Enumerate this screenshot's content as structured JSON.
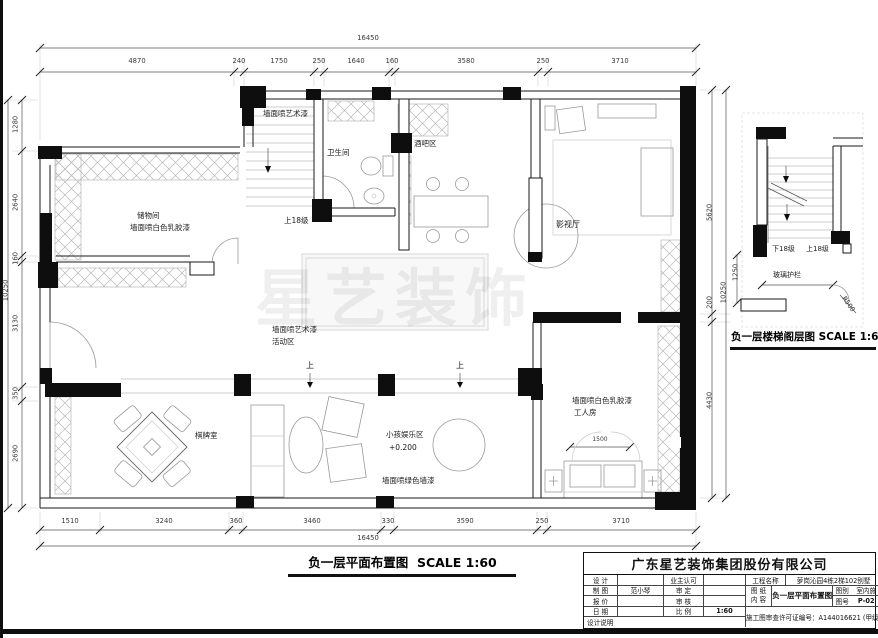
{
  "watermark": "星艺装饰",
  "plan": {
    "title": "负一层平面布置图",
    "title_scale": "SCALE 1:60",
    "dims": {
      "top_total": "16450",
      "top": [
        "4870",
        "240",
        "1750",
        "250",
        "1640",
        "160",
        "3580",
        "250",
        "3710"
      ],
      "bottom": [
        "1510",
        "3240",
        "360",
        "3460",
        "330",
        "3590",
        "250",
        "3710"
      ],
      "bottom_total": "16450",
      "left": [
        "1280",
        "2640",
        "160",
        "3130",
        "350",
        "2690"
      ],
      "left_total": "10250",
      "right": [
        "5620",
        "200",
        "4430"
      ],
      "right_total": "10250",
      "worker_bed": "1500"
    },
    "labels": {
      "art_paint_top": "墙面喷艺术漆",
      "storage": "储物间",
      "storage_paint": "墙面喷白色乳胶漆",
      "bathroom": "卫生间",
      "bar": "酒吧区",
      "stairs_up": "上18级",
      "cinema": "影视厅",
      "activity_paint": "墙面喷艺术漆",
      "activity": "活动区",
      "up1": "上",
      "up2": "上",
      "worker_paint": "墙面喷白色乳胶漆",
      "worker": "工人房",
      "chess": "棋牌室",
      "kids": "小孩娱乐区",
      "kids_level": "+0.200",
      "green_paint": "墙面喷绿色墙漆"
    }
  },
  "stair_plan": {
    "title": "负一层楼梯阁层图",
    "title_scale": "SCALE 1:60",
    "down": "下18级",
    "up": "上18级",
    "glass": "玻璃护栏",
    "radius": "R500",
    "dim_1250": "1250"
  },
  "title_block": {
    "company": "广东星艺装饰集团股份有限公司",
    "rows": [
      {
        "l1": "设  计",
        "v1": "",
        "l2": "业主认可",
        "v2": ""
      },
      {
        "l1": "制  图",
        "v1": "范小琴",
        "l2": "审  定",
        "v2": ""
      },
      {
        "l1": "报  价",
        "v1": "",
        "l2": "审  核",
        "v2": ""
      },
      {
        "l1": "日  期",
        "v1": "",
        "l2": "比  例",
        "v2": "1:60"
      }
    ],
    "design_note": "设计说明",
    "project_label": "工程名称",
    "project_value": "萝岗沁园4栋2梯102别墅",
    "sheet_label_1": "图 纸",
    "sheet_label_2": "内 容",
    "sheet_value": "负一层平面布置图",
    "type_label": "图别",
    "type_value": "室内施",
    "no_label": "图号",
    "no_value": "P-02",
    "permit": "施工图审查许可证编号：A144016621 (甲级)"
  }
}
